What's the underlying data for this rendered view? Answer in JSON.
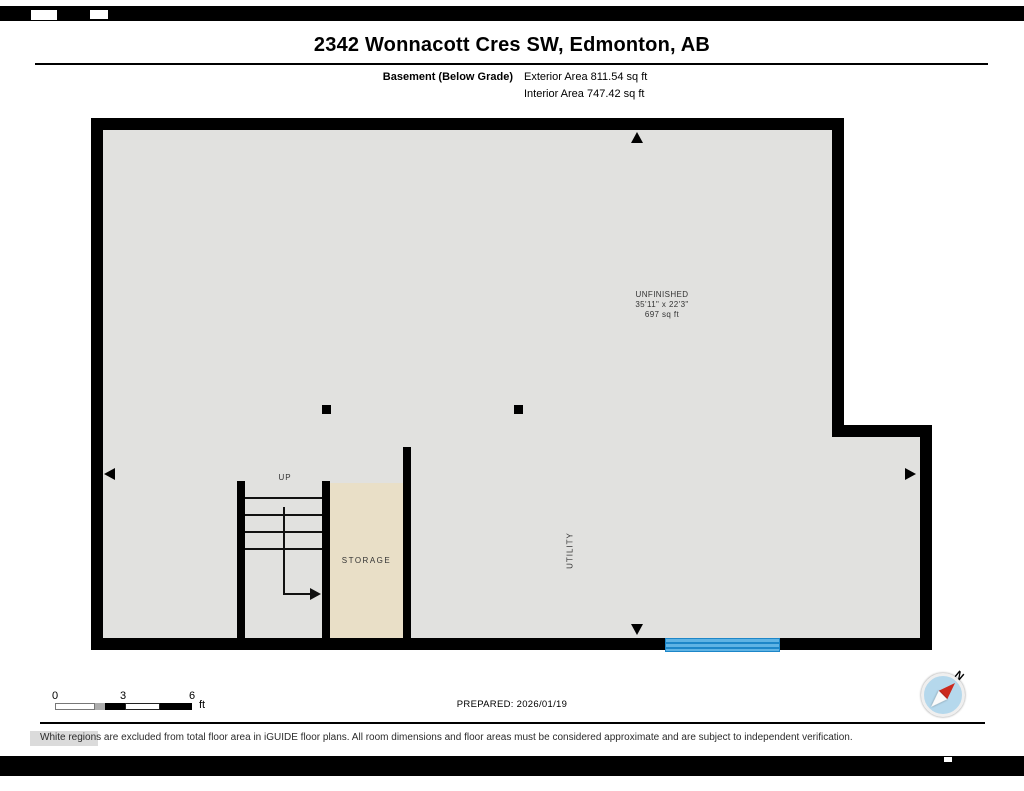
{
  "header": {
    "title": "2342 Wonnacott Cres SW, Edmonton, AB",
    "floor_label": "Basement (Below Grade)",
    "exterior_area": "Exterior Area 811.54 sq ft",
    "interior_area": "Interior Area 747.42 sq ft"
  },
  "floorplan": {
    "room": {
      "name": "UNFINISHED",
      "dimensions": "35'11\" x 22'3\"",
      "area": "697 sq ft"
    },
    "labels": {
      "up": "UP",
      "storage": "STORAGE",
      "utility": "UTILITY"
    },
    "colors": {
      "interior_fill": "#e1e1df",
      "storage_fill": "#e9dfc7",
      "wall": "#000000",
      "window_fill": "#5fb3e4",
      "window_line": "#1d86c8"
    }
  },
  "scale_bar": {
    "tick_0": "0",
    "tick_3": "3",
    "tick_6": "6",
    "unit": "ft"
  },
  "prepared": "PREPARED: 2026/01/19",
  "compass": {
    "north_label": "N",
    "needle_color": "#cc2a1e",
    "face_color": "#b5d8ec"
  },
  "footer": {
    "disclaimer": "White regions are excluded from total floor area in iGUIDE floor plans. All room dimensions and floor areas must be considered approximate and are subject to independent verification."
  }
}
